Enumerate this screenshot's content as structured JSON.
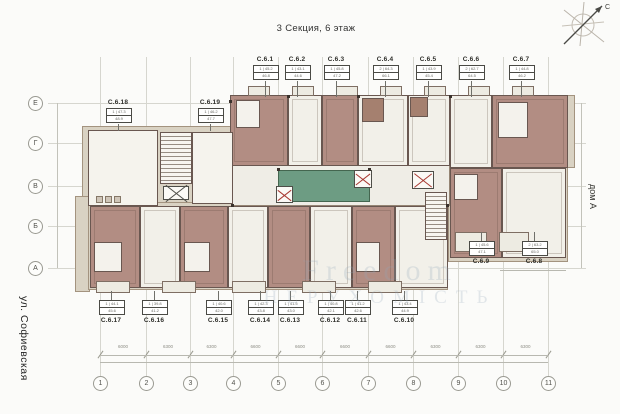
{
  "title": "3 Секция, 6 этаж",
  "street_label": "ул. Софиевская",
  "house_label": "дом А",
  "compass": {
    "north_label": "С"
  },
  "watermark": {
    "line1": "Freedom",
    "line2": "НЕРУХОМІСТЬ"
  },
  "plan": {
    "courtyard_color": "#6d9c83",
    "apartment_fill_color": "#b28d83",
    "room_fill_color": "#f2f0e9",
    "elevator_cross_color": "#a83a32"
  },
  "grid": {
    "columns": [
      {
        "label": "1",
        "x": 100
      },
      {
        "label": "2",
        "x": 146
      },
      {
        "label": "3",
        "x": 190
      },
      {
        "label": "4",
        "x": 233
      },
      {
        "label": "5",
        "x": 278
      },
      {
        "label": "6",
        "x": 322
      },
      {
        "label": "7",
        "x": 368
      },
      {
        "label": "8",
        "x": 413
      },
      {
        "label": "9",
        "x": 458
      },
      {
        "label": "10",
        "x": 503
      },
      {
        "label": "11",
        "x": 548
      }
    ],
    "rows": [
      {
        "label": "Е",
        "y": 103
      },
      {
        "label": "Г",
        "y": 143
      },
      {
        "label": "В",
        "y": 186
      },
      {
        "label": "Б",
        "y": 226
      },
      {
        "label": "А",
        "y": 268
      }
    ],
    "dimensions": [
      "6000",
      "6300",
      "6300",
      "6600",
      "6600",
      "6600",
      "6600",
      "6300",
      "6300",
      "6300"
    ]
  },
  "callouts": {
    "top": [
      {
        "label": "С.6.1",
        "x": 265,
        "info1": "1 | 45.2",
        "info2": "46.8"
      },
      {
        "label": "С.6.2",
        "x": 297,
        "info1": "1 | 43.1",
        "info2": "44.6"
      },
      {
        "label": "С.6.3",
        "x": 336,
        "info1": "1 | 45.8",
        "info2": "47.2"
      },
      {
        "label": "С.6.4",
        "x": 385,
        "info1": "2 | 64.3",
        "info2": "66.1"
      },
      {
        "label": "С.6.5",
        "x": 428,
        "info1": "1 | 43.9",
        "info2": "45.4"
      },
      {
        "label": "С.6.6",
        "x": 471,
        "info1": "2 | 62.7",
        "info2": "64.5"
      },
      {
        "label": "С.6.7",
        "x": 521,
        "info1": "1 | 44.8",
        "info2": "46.2"
      }
    ],
    "upper_left": [
      {
        "label": "С.6.18",
        "x": 118,
        "info1": "1 | 47.3",
        "info2": "48.9"
      },
      {
        "label": "С.6.19",
        "x": 210,
        "info1": "1 | 46.2",
        "info2": "47.7"
      }
    ],
    "bottom": [
      {
        "label": "С.6.17",
        "x": 111,
        "info1": "1 | 44.1",
        "info2": "45.6"
      },
      {
        "label": "С.6.16",
        "x": 154,
        "info1": "1 | 39.8",
        "info2": "41.2"
      },
      {
        "label": "С.6.15",
        "x": 218,
        "info1": "1 | 40.6",
        "info2": "42.0"
      },
      {
        "label": "С.6.14",
        "x": 260,
        "info1": "1 | 42.3",
        "info2": "43.8"
      },
      {
        "label": "С.6.13",
        "x": 290,
        "info1": "1 | 41.5",
        "info2": "43.0"
      },
      {
        "label": "С.6.12",
        "x": 330,
        "info1": "1 | 40.8",
        "info2": "42.1"
      },
      {
        "label": "С.6.11",
        "x": 357,
        "info1": "1 | 41.2",
        "info2": "42.6"
      },
      {
        "label": "С.6.10",
        "x": 404,
        "info1": "1 | 43.4",
        "info2": "44.9"
      }
    ],
    "right": [
      {
        "label": "С.6.9",
        "x": 481,
        "info1": "1 | 45.6",
        "info2": "47.1"
      },
      {
        "label": "С.6.8",
        "x": 534,
        "info1": "2 | 63.2",
        "info2": "65.0"
      }
    ]
  }
}
